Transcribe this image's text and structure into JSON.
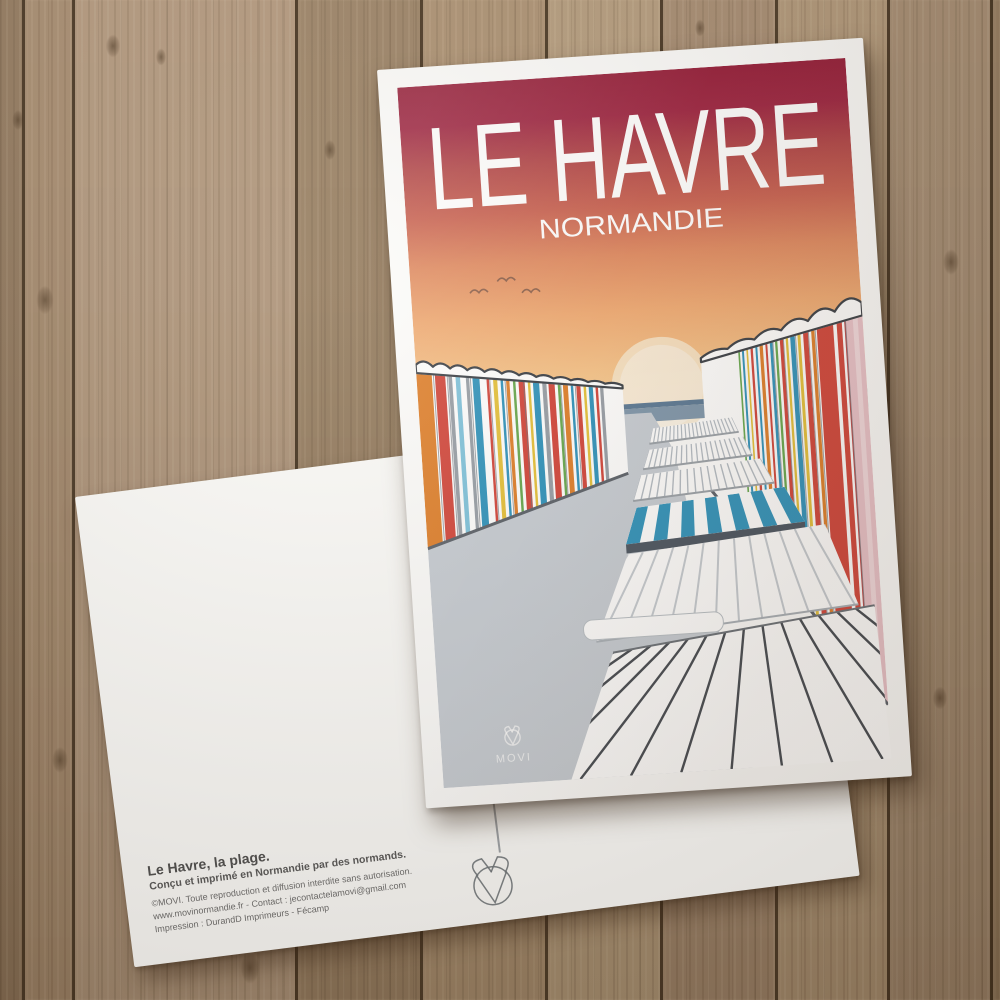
{
  "wood": {
    "planks": [
      {
        "w": 22,
        "c": "#8e7458"
      },
      {
        "w": 50,
        "c": "#a4886a"
      },
      {
        "w": 223,
        "c": "#b09579"
      },
      {
        "w": 125,
        "c": "#987e60"
      },
      {
        "w": 125,
        "c": "#a98d6d"
      },
      {
        "w": 115,
        "c": "#b29877"
      },
      {
        "w": 115,
        "c": "#a2866a"
      },
      {
        "w": 112,
        "c": "#ad9272"
      },
      {
        "w": 103,
        "c": "#a1876b"
      },
      {
        "w": 10,
        "c": "#8f7557"
      }
    ],
    "knots": [
      [
        113,
        46,
        16
      ],
      [
        161,
        57,
        12
      ],
      [
        45,
        300,
        20
      ],
      [
        330,
        150,
        14
      ],
      [
        951,
        262,
        18
      ],
      [
        940,
        698,
        16
      ],
      [
        60,
        760,
        18
      ],
      [
        250,
        968,
        22
      ],
      [
        700,
        28,
        12
      ],
      [
        18,
        120,
        14
      ]
    ]
  },
  "poster": {
    "title": "LE HAVRE",
    "subtitle": "NORMANDIE",
    "brand": "MOVI",
    "colors": {
      "sky": [
        [
          0,
          "#951c38"
        ],
        [
          0.12,
          "#9d2340"
        ],
        [
          0.24,
          "#b24547"
        ],
        [
          0.38,
          "#c96150"
        ],
        [
          0.52,
          "#e08a60"
        ],
        [
          0.68,
          "#f0aa72"
        ],
        [
          0.85,
          "#f6c388"
        ],
        [
          1,
          "#f9d29b"
        ]
      ],
      "sun": "#f9ead0",
      "sea": "#7e96ab",
      "sea_dark": "#5a7894",
      "path": "#c7cdd4",
      "roof_line": "#3a3f46",
      "hut_orange": "#df7f2a",
      "hut_red": "#d2453a",
      "hut_blue": "#2f93bc",
      "hut_yellow": "#e5c13a",
      "hut_green": "#67a84e",
      "hut_pink": "#eac3ca"
    },
    "scene": {
      "birds": [
        [
          68,
          210
        ],
        [
          96,
          200
        ],
        [
          120,
          213
        ]
      ],
      "left_row": {
        "x0": 0,
        "x1": 205,
        "t0": 278,
        "t1": 312,
        "b0": 462,
        "b1": 400,
        "band0": 9,
        "band1": 4,
        "bumps": 12,
        "h0": 9,
        "h1": 3,
        "stripes": [
          [
            0,
            0.075,
            "#df7f2a"
          ],
          [
            0.09,
            0.05,
            "#d2453a"
          ],
          [
            0.155,
            0.018,
            "#979ea6"
          ],
          [
            0.19,
            0.022,
            "#7fc3dc"
          ],
          [
            0.24,
            0.016,
            "#979ea6"
          ],
          [
            0.272,
            0.034,
            "#2f93bc"
          ],
          [
            0.34,
            0.012,
            "#d2453a"
          ],
          [
            0.372,
            0.02,
            "#e5c13a"
          ],
          [
            0.408,
            0.012,
            "#2f93bc"
          ],
          [
            0.435,
            0.016,
            "#df7f2a"
          ],
          [
            0.468,
            0.012,
            "#67a84e"
          ],
          [
            0.495,
            0.03,
            "#d2453a"
          ],
          [
            0.54,
            0.012,
            "#e5c13a"
          ],
          [
            0.565,
            0.03,
            "#2f93bc"
          ],
          [
            0.61,
            0.016,
            "#979ea6"
          ],
          [
            0.64,
            0.03,
            "#d2453a"
          ],
          [
            0.685,
            0.012,
            "#67a84e"
          ],
          [
            0.71,
            0.024,
            "#df7f2a"
          ],
          [
            0.748,
            0.012,
            "#2f93bc"
          ],
          [
            0.775,
            0.02,
            "#d2453a"
          ],
          [
            0.81,
            0.012,
            "#e5c13a"
          ],
          [
            0.835,
            0.02,
            "#2f93bc"
          ],
          [
            0.868,
            0.012,
            "#d2453a"
          ],
          [
            0.89,
            0.016,
            "#979ea6"
          ]
        ],
        "seps": [
          0.083,
          0.15,
          0.262,
          0.356,
          0.43,
          0.52,
          0.628,
          0.7,
          0.77
        ]
      },
      "right_row": {
        "x0": 449,
        "x1": 285,
        "t0": 245,
        "t1": 290,
        "b0": 648,
        "b1": 420,
        "band0": 14,
        "band1": 5,
        "bumps": 6,
        "h0": 17,
        "h1": 5,
        "stripes": [
          [
            0,
            0.105,
            "#eac3ca"
          ],
          [
            0.03,
            0.03,
            "#f3dade"
          ],
          [
            0.105,
            0.008,
            "#c24545"
          ],
          [
            0.128,
            0.155,
            "#d2453a"
          ],
          [
            0.16,
            0.022,
            "#ffffff"
          ],
          [
            0.298,
            0.02,
            "#df7f2a"
          ],
          [
            0.338,
            0.03,
            "#d2453a"
          ],
          [
            0.385,
            0.018,
            "#e5c13a"
          ],
          [
            0.42,
            0.028,
            "#2f93bc"
          ],
          [
            0.462,
            0.014,
            "#e5c13a"
          ],
          [
            0.492,
            0.02,
            "#d2453a"
          ],
          [
            0.528,
            0.014,
            "#67a84e"
          ],
          [
            0.558,
            0.016,
            "#2f93bc"
          ],
          [
            0.59,
            0.012,
            "#d2453a"
          ],
          [
            0.618,
            0.02,
            "#df7f2a"
          ],
          [
            0.652,
            0.012,
            "#2f93bc"
          ],
          [
            0.68,
            0.014,
            "#d2453a"
          ],
          [
            0.71,
            0.01,
            "#e5c13a"
          ],
          [
            0.735,
            0.012,
            "#2f93bc"
          ],
          [
            0.76,
            0.01,
            "#67a84e"
          ]
        ],
        "seps": [
          0.105,
          0.293,
          0.335,
          0.415,
          0.49,
          0.555
        ]
      },
      "decks": [
        {
          "q": [
            232,
            357,
            312,
            351,
            318,
            366,
            228,
            372
          ],
          "n": 22,
          "s": 1,
          "sw": 1.2,
          "sc": "#b4bcc4",
          "bl": "#9aa1a8"
        },
        {
          "q": [
            227,
            378,
            322,
            371,
            330,
            390,
            220,
            397
          ],
          "n": 20,
          "s": 1,
          "sw": 1.3,
          "sc": "#b4bcc4",
          "bl": "#9aa1a8"
        },
        {
          "q": [
            217,
            403,
            338,
            394,
            350,
            419,
            208,
            428
          ],
          "n": 18,
          "s": 1,
          "sw": 1.4,
          "sc": "#b4bcc4",
          "bl": "#9aa1a8"
        },
        {
          "q": [
            211,
            435,
            360,
            424,
            378,
            460,
            198,
            471
          ],
          "stripes": 13,
          "color": "#2f93bc",
          "front": "#4a5460",
          "fh": 9
        },
        {
          "q": [
            199,
            481,
            398,
            464,
            426,
            546,
            162,
            566
          ],
          "n": 13,
          "s": 1.15,
          "sw": 2,
          "sc": "#c6ccd2",
          "bl": "#a9b0b7",
          "tongue": [
            150,
            544,
            140,
            20
          ]
        },
        {
          "q": [
            178,
            578,
            442,
            548,
            449,
            702,
            128,
            702
          ],
          "n": 14,
          "s": 2.2,
          "sw": 2.4,
          "sc": "#454a51",
          "tl": "#6a7077"
        }
      ]
    }
  },
  "back": {
    "line1": "Le Havre, la plage.",
    "line2": "Conçu et imprimé en Normandie par des normands.",
    "line3": "©MOVI. Toute reproduction et diffusion interdite sans autorisation.",
    "line4": "www.movinormandie.fr - Contact : jecontactelamovi@gmail.com",
    "line5": "Impression : DurandD Imprimeurs - Fécamp"
  }
}
